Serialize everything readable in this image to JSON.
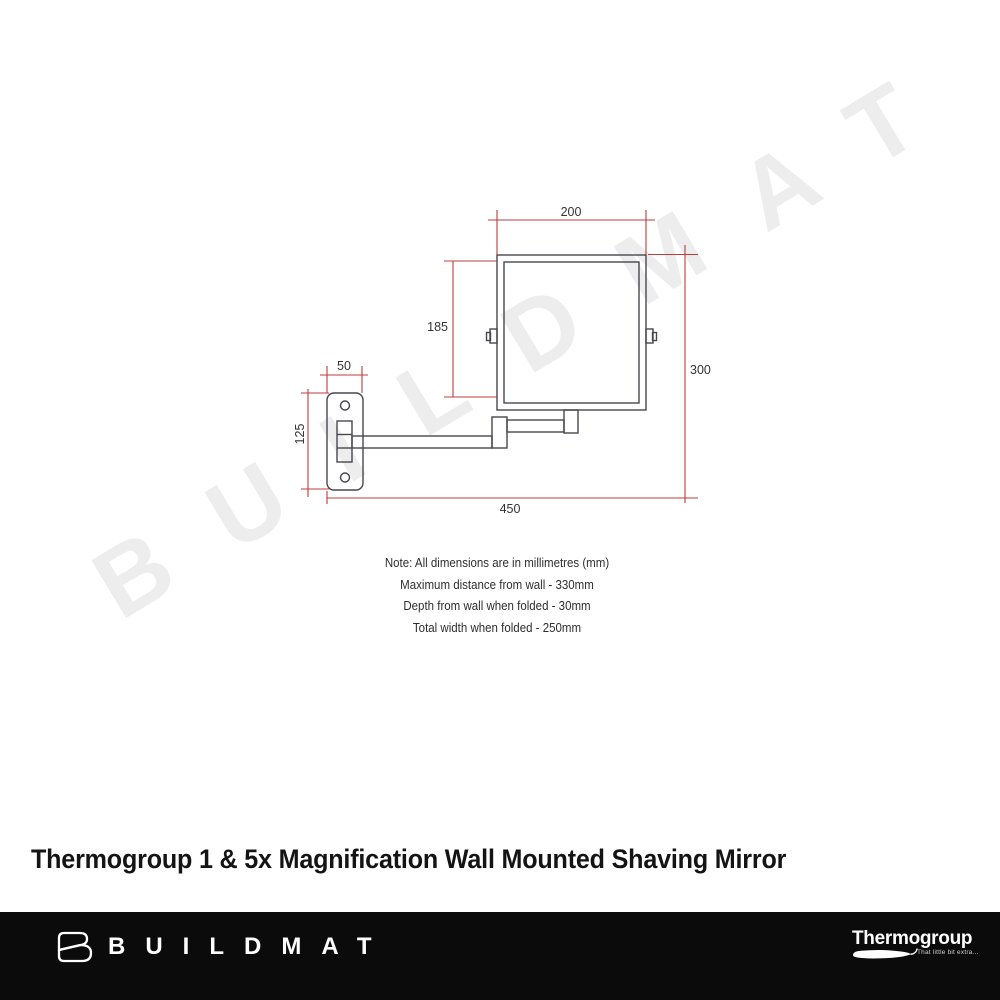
{
  "watermark": {
    "text": "BUILDMAT",
    "color": "#ededed"
  },
  "drawing": {
    "line_color": "#46464e",
    "dim_color": "#c23b3b",
    "dims": {
      "mirror_width": "200",
      "mirror_height": "185",
      "overall_height": "300",
      "plate_width": "50",
      "plate_height": "125",
      "overall_width": "450"
    }
  },
  "notes": {
    "line1": "Note: All dimensions are in millimetres (mm)",
    "line2": "Maximum distance from wall - 330mm",
    "line3": "Depth from wall when folded - 30mm",
    "line4": "Total width when folded - 250mm"
  },
  "title": "Thermogroup 1 & 5x Magnification Wall Mounted Shaving Mirror",
  "footer": {
    "brand": "BUILDMAT",
    "supplier": {
      "name": "Thermogroup",
      "tagline": "That little bit extra..."
    }
  }
}
